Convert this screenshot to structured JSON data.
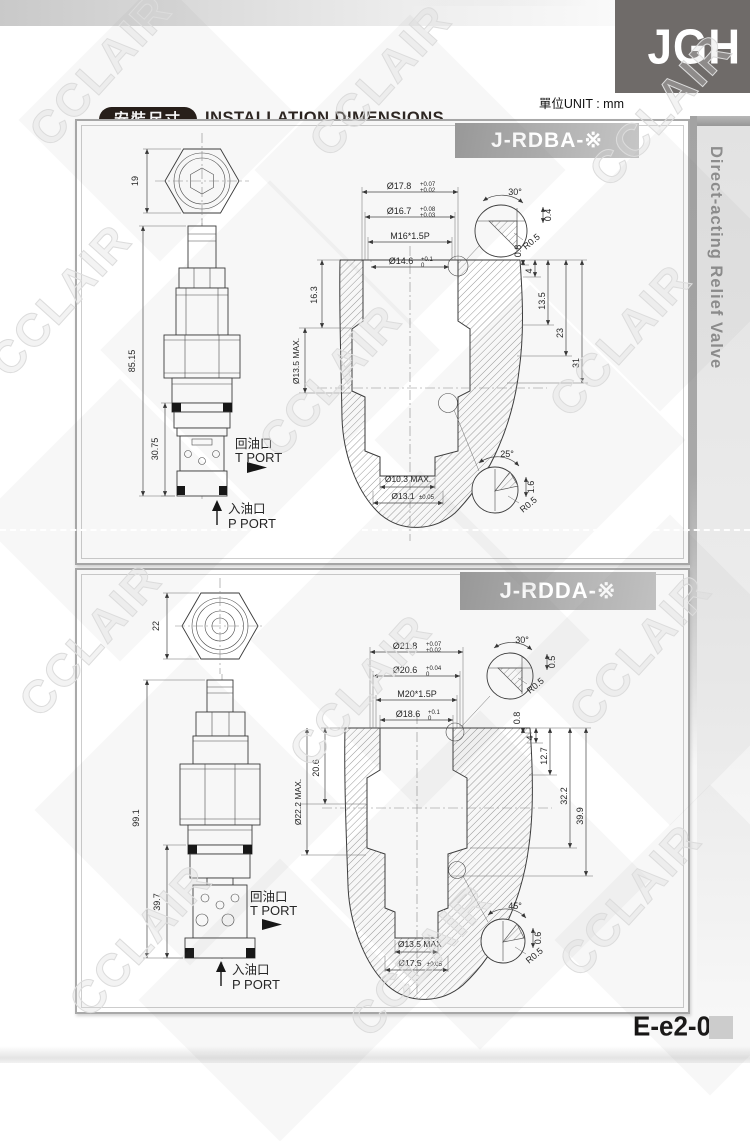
{
  "page": {
    "logo_text": "JGH",
    "unit_label": "單位UNIT : mm",
    "title_zh": "安裝尺寸",
    "title_en": "INSTALLATION DIMENSIONS",
    "sidebar_label": "Direct-acting Relief Valve",
    "page_code": "E-e2-02",
    "watermark_text": "CCLAIR"
  },
  "drawings": [
    {
      "model": "J-RDBA-※",
      "top_view": {
        "across_flats": "19"
      },
      "side_view": {
        "overall_height": "85.15",
        "insert_depth": "30.75",
        "t_port_zh": "回油口",
        "t_port_en": "T PORT",
        "p_port_zh": "入油口",
        "p_port_en": "P PORT"
      },
      "cavity": {
        "bores": [
          {
            "label": "Ø17.8",
            "tol_up": "+0.07",
            "tol_dn": "+0.02"
          },
          {
            "label": "Ø16.7",
            "tol_up": "+0.08",
            "tol_dn": "+0.03"
          },
          {
            "label": "M16*1.5P",
            "tol_up": "",
            "tol_dn": ""
          },
          {
            "label": "Ø14.6",
            "tol_up": "+0.1",
            "tol_dn": "0"
          }
        ],
        "top_detail": {
          "angle": "30°",
          "chamfer": "0.4",
          "radius": "R0.5"
        },
        "depth_dims": [
          "0.8",
          "4",
          "13.5",
          "23",
          "31"
        ],
        "side_depth": "16.3",
        "side_dia": "Ø13.5 MAX.",
        "bottom_dia_1": "Ø10.3 MAX.",
        "bottom_dia_2": "Ø13.1",
        "bottom_dia_2_tol": "±0.05",
        "bottom_detail": {
          "angle": "25°",
          "chamfer": "1.6",
          "radius": "R0.5"
        }
      }
    },
    {
      "model": "J-RDDA-※",
      "top_view": {
        "across_flats": "22"
      },
      "side_view": {
        "overall_height": "99.1",
        "insert_depth": "39.7",
        "t_port_zh": "回油口",
        "t_port_en": "T PORT",
        "p_port_zh": "入油口",
        "p_port_en": "P PORT"
      },
      "cavity": {
        "bores": [
          {
            "label": "Ø21.8",
            "tol_up": "+0.07",
            "tol_dn": "+0.02"
          },
          {
            "label": "Ø20.6",
            "tol_up": "+0.04",
            "tol_dn": "0"
          },
          {
            "label": "M20*1.5P",
            "tol_up": "",
            "tol_dn": ""
          },
          {
            "label": "Ø18.6",
            "tol_up": "+0.1",
            "tol_dn": "0"
          }
        ],
        "top_detail": {
          "angle": "30°",
          "chamfer": "0.5",
          "radius": "R0.5"
        },
        "depth_dims": [
          "0.8",
          "4",
          "12.7",
          "32.2",
          "39.9"
        ],
        "side_depth": "20.6",
        "side_dia": "Ø22.2 MAX.",
        "bottom_dia_1": "Ø13.5 MAX.",
        "bottom_dia_2": "Ø17.5",
        "bottom_dia_2_tol": "±0.05",
        "bottom_detail": {
          "angle": "45°",
          "chamfer": "0.6",
          "radius": "R0.5"
        }
      }
    }
  ]
}
